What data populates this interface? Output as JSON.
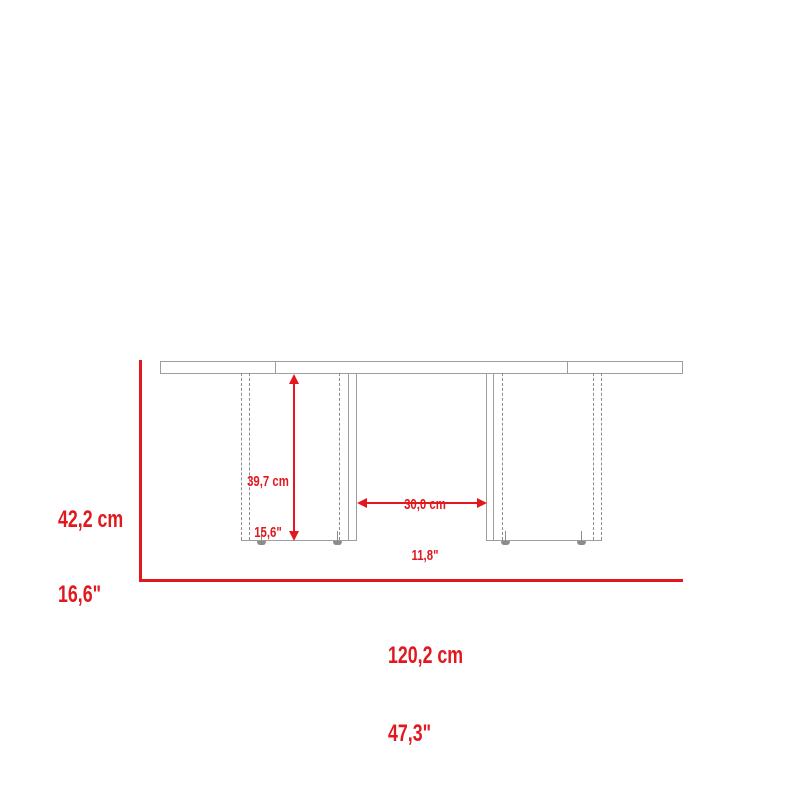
{
  "diagram": {
    "subject": "table-front-view-dimension-diagram",
    "colors": {
      "dimension_accent": "#e2181f",
      "product_outline": "#9e9e9e",
      "hidden_edge": "#8c8c8c",
      "background": "#ffffff"
    },
    "measurements": {
      "overall_height": {
        "cm": "42,2 cm",
        "inches": "16,6\""
      },
      "leg_height": {
        "cm": "39,7 cm",
        "inches": "15,6\""
      },
      "leg_clearance": {
        "cm": "30,0 cm",
        "inches": "11,8\""
      },
      "overall_width": {
        "cm": "120,2 cm",
        "inches": "47,3\""
      }
    }
  }
}
